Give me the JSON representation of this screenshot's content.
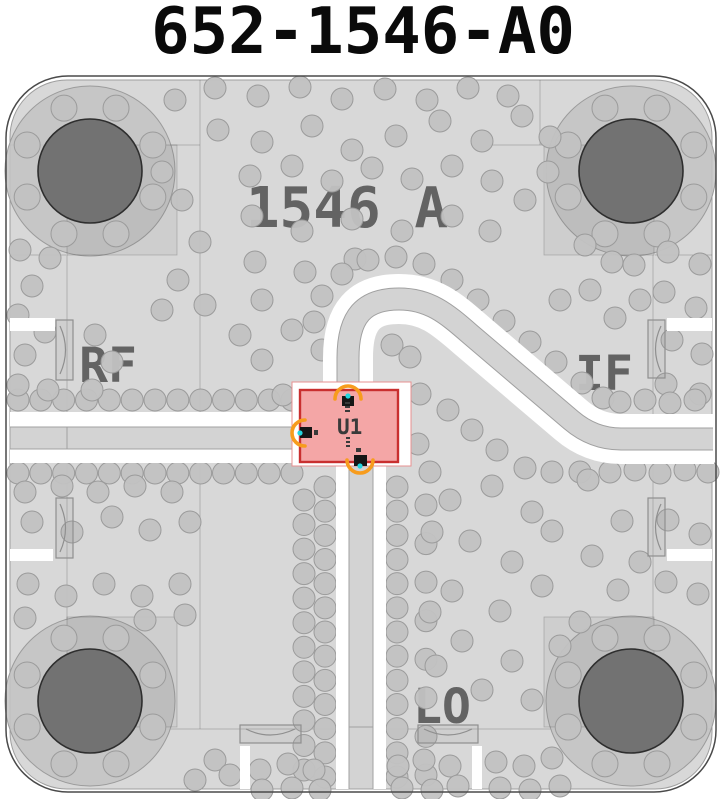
{
  "title": "652-1546-A0",
  "board": {
    "name_label": "1546 A",
    "ports": {
      "rf": "RF",
      "if": "IF",
      "lo": "LO"
    },
    "component": {
      "designator": "U1"
    }
  },
  "colors": {
    "title_color": "#0a0a0a",
    "board_fill": "#d8d8d8",
    "board_outline": "#4a4a4a",
    "board_inner_stroke": "#9e9e9e",
    "pour_line": "rgba(0,0,0,0.18)",
    "via_fill": "#c2c2c2",
    "via_stroke": "#9b9b9b",
    "hole_ring": "#c3c3c3",
    "hole_dark": "#727272",
    "hole_dark_stroke": "#2e2e2e",
    "channel_white": "#ffffff",
    "trace_fill": "#d3d3d3",
    "trace_stroke": "#a0a0a0",
    "silkscreen_text": "#636363",
    "connector_stroke": "#8f8f8f",
    "component_fill": "#f4a6a6",
    "component_stroke": "#c92f2f",
    "component_halo_stroke": "#e79090",
    "ratsnest_orange": "#f79c1d",
    "pad_black": "#161616",
    "pin_cyan": "#23d5de",
    "refdes_color": "#3a3a3a"
  },
  "holes": {
    "centers": [
      [
        90,
        171
      ],
      [
        631,
        171
      ],
      [
        90,
        701
      ],
      [
        631,
        701
      ]
    ],
    "ring_r": 85,
    "hole_r": 52,
    "via_ring_r": 68,
    "via_ring_count": 8,
    "ring_via_r": 13
  },
  "vias": {
    "r": 11,
    "rows": [
      [
        18,
        400,
        292,
        400,
        13
      ],
      [
        18,
        473,
        292,
        473,
        13
      ],
      [
        325,
        487,
        325,
        777,
        13
      ],
      [
        397,
        487,
        397,
        777,
        13
      ],
      [
        304,
        500,
        304,
        770,
        12
      ],
      [
        426,
        505,
        426,
        775,
        8
      ]
    ],
    "points": [
      [
        175,
        100
      ],
      [
        215,
        88
      ],
      [
        258,
        96
      ],
      [
        300,
        87
      ],
      [
        342,
        99
      ],
      [
        385,
        89
      ],
      [
        427,
        100
      ],
      [
        468,
        88
      ],
      [
        508,
        96
      ],
      [
        218,
        130
      ],
      [
        262,
        142
      ],
      [
        312,
        126
      ],
      [
        352,
        150
      ],
      [
        396,
        136
      ],
      [
        440,
        121
      ],
      [
        482,
        141
      ],
      [
        522,
        116
      ],
      [
        550,
        137
      ],
      [
        250,
        176
      ],
      [
        292,
        166
      ],
      [
        332,
        181
      ],
      [
        372,
        168
      ],
      [
        412,
        179
      ],
      [
        452,
        166
      ],
      [
        492,
        181
      ],
      [
        525,
        200
      ],
      [
        548,
        172
      ],
      [
        252,
        216
      ],
      [
        302,
        231
      ],
      [
        352,
        219
      ],
      [
        402,
        231
      ],
      [
        452,
        216
      ],
      [
        490,
        231
      ],
      [
        182,
        200
      ],
      [
        200,
        242
      ],
      [
        162,
        172
      ],
      [
        255,
        262
      ],
      [
        305,
        272
      ],
      [
        355,
        259
      ],
      [
        262,
        300
      ],
      [
        292,
        330
      ],
      [
        262,
        360
      ],
      [
        240,
        335
      ],
      [
        178,
        280
      ],
      [
        205,
        305
      ],
      [
        162,
        310
      ],
      [
        20,
        250
      ],
      [
        50,
        258
      ],
      [
        32,
        286
      ],
      [
        18,
        315
      ],
      [
        45,
        332
      ],
      [
        25,
        355
      ],
      [
        18,
        385
      ],
      [
        48,
        390
      ],
      [
        95,
        335
      ],
      [
        112,
        362
      ],
      [
        92,
        390
      ],
      [
        585,
        245
      ],
      [
        612,
        262
      ],
      [
        590,
        290
      ],
      [
        615,
        318
      ],
      [
        560,
        300
      ],
      [
        634,
        265
      ],
      [
        640,
        300
      ],
      [
        668,
        252
      ],
      [
        700,
        264
      ],
      [
        664,
        292
      ],
      [
        696,
        308
      ],
      [
        672,
        340
      ],
      [
        702,
        354
      ],
      [
        666,
        384
      ],
      [
        700,
        394
      ],
      [
        668,
        520
      ],
      [
        700,
        534
      ],
      [
        666,
        582
      ],
      [
        698,
        594
      ],
      [
        322,
        350
      ],
      [
        314,
        322
      ],
      [
        322,
        296
      ],
      [
        342,
        274
      ],
      [
        368,
        260
      ],
      [
        396,
        257
      ],
      [
        424,
        264
      ],
      [
        452,
        280
      ],
      [
        478,
        300
      ],
      [
        504,
        321
      ],
      [
        530,
        342
      ],
      [
        556,
        362
      ],
      [
        582,
        383
      ],
      [
        603,
        398
      ],
      [
        620,
        402
      ],
      [
        645,
        400
      ],
      [
        670,
        403
      ],
      [
        695,
        400
      ],
      [
        610,
        472
      ],
      [
        635,
        470
      ],
      [
        660,
        473
      ],
      [
        685,
        470
      ],
      [
        708,
        472
      ],
      [
        392,
        345
      ],
      [
        410,
        357
      ],
      [
        448,
        410
      ],
      [
        472,
        430
      ],
      [
        497,
        450
      ],
      [
        525,
        468
      ],
      [
        552,
        472
      ],
      [
        580,
        472
      ],
      [
        450,
        500
      ],
      [
        492,
        486
      ],
      [
        532,
        512
      ],
      [
        470,
        541
      ],
      [
        512,
        562
      ],
      [
        552,
        531
      ],
      [
        592,
        556
      ],
      [
        452,
        591
      ],
      [
        500,
        611
      ],
      [
        542,
        586
      ],
      [
        580,
        622
      ],
      [
        618,
        590
      ],
      [
        462,
        641
      ],
      [
        512,
        661
      ],
      [
        560,
        646
      ],
      [
        482,
        690
      ],
      [
        532,
        700
      ],
      [
        430,
        472
      ],
      [
        588,
        480
      ],
      [
        622,
        521
      ],
      [
        640,
        562
      ],
      [
        432,
        532
      ],
      [
        430,
        612
      ],
      [
        436,
        666
      ],
      [
        25,
        492
      ],
      [
        62,
        486
      ],
      [
        98,
        492
      ],
      [
        135,
        486
      ],
      [
        172,
        492
      ],
      [
        32,
        522
      ],
      [
        72,
        532
      ],
      [
        112,
        517
      ],
      [
        150,
        530
      ],
      [
        190,
        522
      ],
      [
        28,
        584
      ],
      [
        66,
        596
      ],
      [
        104,
        584
      ],
      [
        142,
        596
      ],
      [
        180,
        584
      ],
      [
        25,
        618
      ],
      [
        145,
        620
      ],
      [
        185,
        615
      ],
      [
        215,
        760
      ],
      [
        230,
        775
      ],
      [
        260,
        770
      ],
      [
        288,
        764
      ],
      [
        314,
        770
      ],
      [
        262,
        790
      ],
      [
        292,
        788
      ],
      [
        320,
        790
      ],
      [
        195,
        780
      ],
      [
        398,
        766
      ],
      [
        424,
        760
      ],
      [
        450,
        766
      ],
      [
        402,
        788
      ],
      [
        432,
        790
      ],
      [
        458,
        786
      ],
      [
        496,
        762
      ],
      [
        524,
        766
      ],
      [
        552,
        758
      ],
      [
        500,
        788
      ],
      [
        530,
        790
      ],
      [
        560,
        786
      ],
      [
        283,
        395
      ],
      [
        283,
        440
      ],
      [
        420,
        394
      ],
      [
        418,
        444
      ]
    ]
  }
}
